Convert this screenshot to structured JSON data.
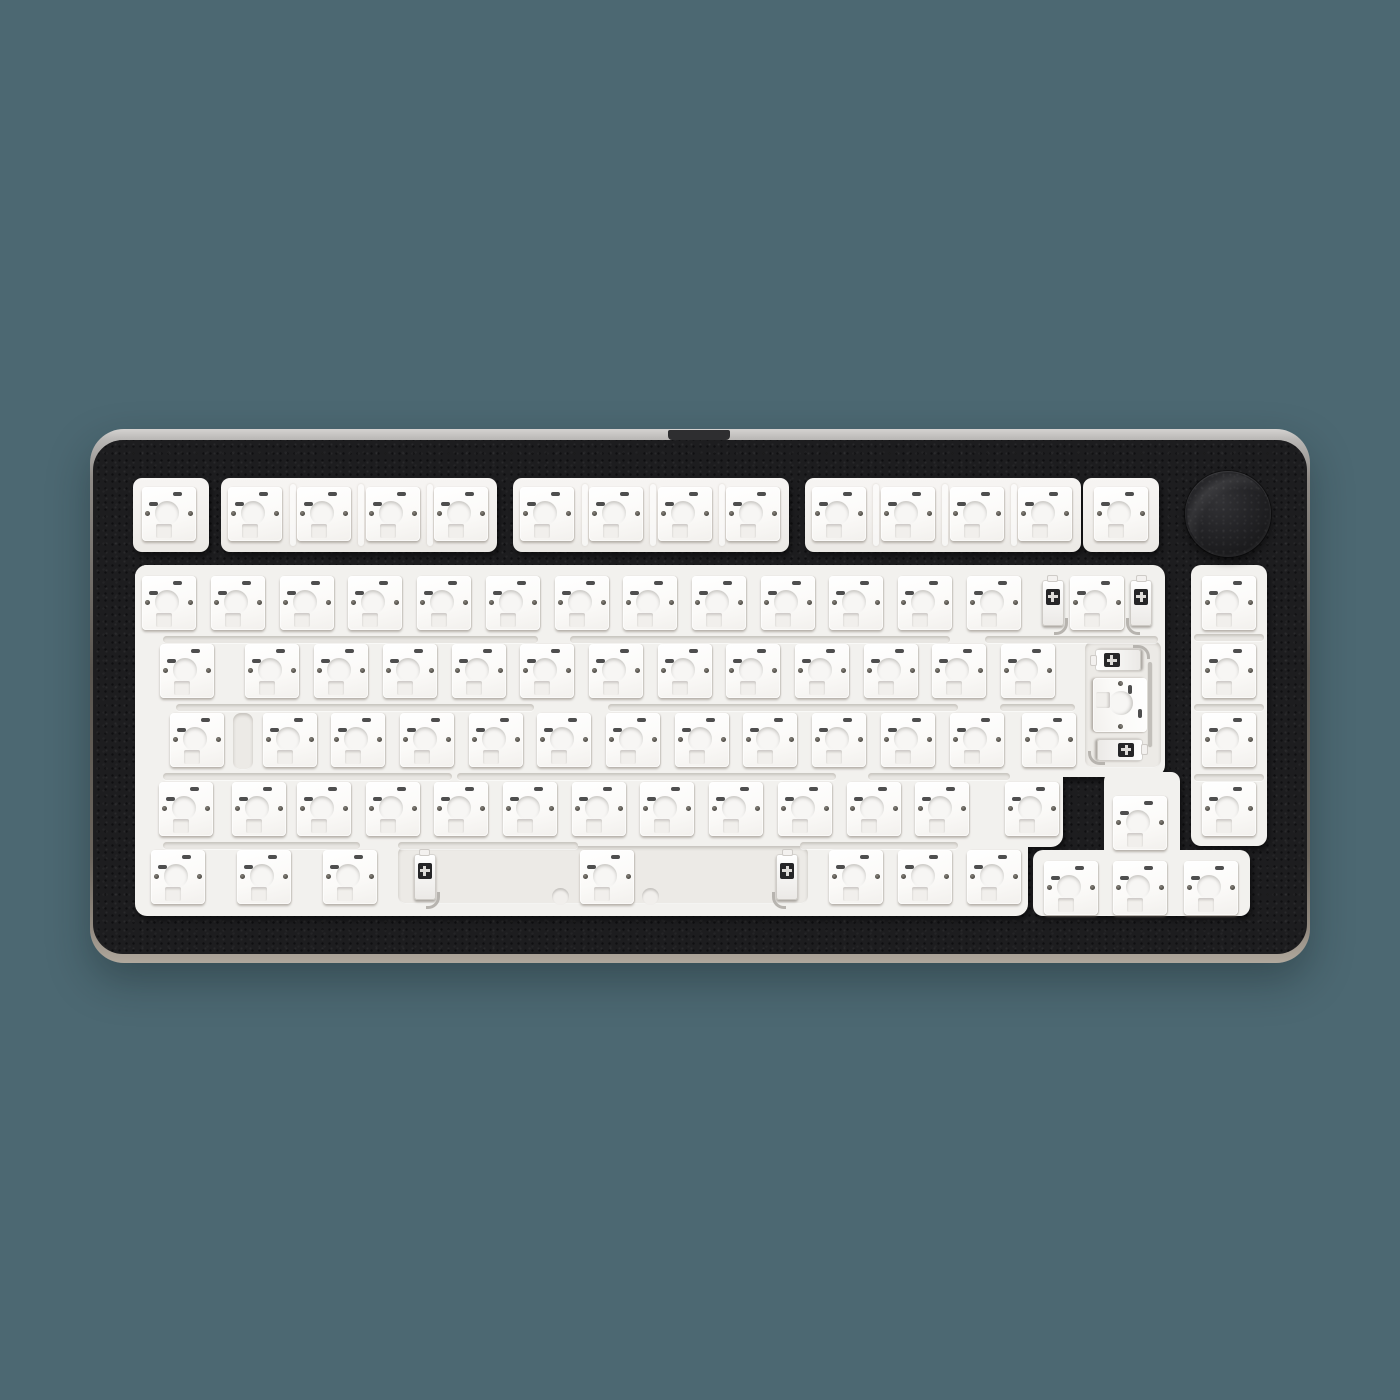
{
  "scene": {
    "type": "product-photo",
    "subject": "75 percent barebones hot-swap mechanical keyboard with black aluminum case, white plate with empty hot-swap sockets, no keycaps, and a black rotary knob in the top right corner",
    "background_color": "#4c6872"
  },
  "keyboard": {
    "form_factor": "75% exploded layout with knob",
    "keycaps_installed": false,
    "socket_count": 83,
    "colors": {
      "case": "#1d1d1f",
      "case_speckle": "#3c3c3e",
      "rim_top": "#cac8c6",
      "rim_bottom": "#aba396",
      "plate": "#f2f1ee",
      "socket": "#fbfaf8",
      "recess": "#eceae6",
      "knob": "#1b1b1d",
      "stab_slot": "#262628",
      "contact_dot": "#4a4842",
      "pin_dash": "#2f2f2f",
      "background": "#4c6872"
    },
    "knob": {
      "present": true,
      "position": "top-right",
      "shape": "round"
    },
    "rows": [
      {
        "id": "function-row",
        "keys": [
          {
            "id": "esc",
            "cu": 0.5
          },
          {
            "id": "f1",
            "cu": 1.75
          },
          {
            "id": "f2",
            "cu": 2.75
          },
          {
            "id": "f3",
            "cu": 3.75
          },
          {
            "id": "f4",
            "cu": 4.75
          },
          {
            "id": "f5",
            "cu": 6.0
          },
          {
            "id": "f6",
            "cu": 7.0
          },
          {
            "id": "f7",
            "cu": 8.0
          },
          {
            "id": "f8",
            "cu": 9.0
          },
          {
            "id": "f9",
            "cu": 10.25
          },
          {
            "id": "f10",
            "cu": 11.25
          },
          {
            "id": "f11",
            "cu": 12.25
          },
          {
            "id": "f12",
            "cu": 13.25
          },
          {
            "id": "del",
            "cu": 14.35
          }
        ]
      },
      {
        "id": "number-row",
        "keys": [
          {
            "id": "grave",
            "cu": 0.5
          },
          {
            "id": "num1",
            "cu": 1.5
          },
          {
            "id": "num2",
            "cu": 2.5
          },
          {
            "id": "num3",
            "cu": 3.5
          },
          {
            "id": "num4",
            "cu": 4.5
          },
          {
            "id": "num5",
            "cu": 5.5
          },
          {
            "id": "num6",
            "cu": 6.5
          },
          {
            "id": "num7",
            "cu": 7.5
          },
          {
            "id": "num8",
            "cu": 8.5
          },
          {
            "id": "num9",
            "cu": 9.5
          },
          {
            "id": "num0",
            "cu": 10.5
          },
          {
            "id": "minus",
            "cu": 11.5
          },
          {
            "id": "equals",
            "cu": 12.5
          },
          {
            "id": "backspace",
            "cu": 14.0
          }
        ]
      },
      {
        "id": "upper-row",
        "keys": [
          {
            "id": "tab",
            "cu": 0.75
          },
          {
            "id": "q",
            "cu": 2.0
          },
          {
            "id": "w",
            "cu": 3.0
          },
          {
            "id": "e",
            "cu": 4.0
          },
          {
            "id": "r",
            "cu": 5.0
          },
          {
            "id": "t",
            "cu": 6.0
          },
          {
            "id": "y",
            "cu": 7.0
          },
          {
            "id": "u",
            "cu": 8.0
          },
          {
            "id": "i",
            "cu": 9.0
          },
          {
            "id": "o",
            "cu": 10.0
          },
          {
            "id": "p",
            "cu": 11.0
          },
          {
            "id": "lbracket",
            "cu": 12.0
          },
          {
            "id": "rbracket",
            "cu": 13.0
          }
        ]
      },
      {
        "id": "home-row",
        "keys": [
          {
            "id": "caps",
            "cu": 0.9
          },
          {
            "id": "a",
            "cu": 2.25
          },
          {
            "id": "s",
            "cu": 3.25
          },
          {
            "id": "d",
            "cu": 4.25
          },
          {
            "id": "f",
            "cu": 5.25
          },
          {
            "id": "g",
            "cu": 6.25
          },
          {
            "id": "h",
            "cu": 7.25
          },
          {
            "id": "j",
            "cu": 8.25
          },
          {
            "id": "k",
            "cu": 9.25
          },
          {
            "id": "l",
            "cu": 10.25
          },
          {
            "id": "semicolon",
            "cu": 11.25
          },
          {
            "id": "quote",
            "cu": 12.25
          },
          {
            "id": "enter",
            "cu": 13.3
          }
        ]
      },
      {
        "id": "lower-row",
        "keys": [
          {
            "id": "lshift",
            "cu": 0.74
          },
          {
            "id": "iso-backslash",
            "cu": 1.8
          },
          {
            "id": "z",
            "cu": 2.75
          },
          {
            "id": "x",
            "cu": 3.75
          },
          {
            "id": "c",
            "cu": 4.75
          },
          {
            "id": "v",
            "cu": 5.75
          },
          {
            "id": "b",
            "cu": 6.75
          },
          {
            "id": "n",
            "cu": 7.75
          },
          {
            "id": "m",
            "cu": 8.75
          },
          {
            "id": "comma",
            "cu": 9.75
          },
          {
            "id": "period",
            "cu": 10.75
          },
          {
            "id": "slash",
            "cu": 11.75
          },
          {
            "id": "rshift",
            "cu": 13.06
          }
        ]
      },
      {
        "id": "bottom-row",
        "keys": [
          {
            "id": "lctrl",
            "cu": 0.625
          },
          {
            "id": "lwin",
            "cu": 1.875
          },
          {
            "id": "lalt",
            "cu": 3.125
          },
          {
            "id": "space",
            "cu": 6.875
          },
          {
            "id": "ralt",
            "cu": 10.5
          },
          {
            "id": "fn",
            "cu": 11.5
          },
          {
            "id": "rctrl",
            "cu": 12.5
          }
        ]
      }
    ],
    "right_column_keys": [
      {
        "id": "home"
      },
      {
        "id": "pageup"
      },
      {
        "id": "pagedown"
      },
      {
        "id": "end"
      }
    ],
    "arrow_keys": [
      {
        "id": "up"
      },
      {
        "id": "left"
      },
      {
        "id": "down"
      },
      {
        "id": "right"
      }
    ],
    "extra_sockets": [
      {
        "id": "iso-enter",
        "rotated": true
      }
    ],
    "stabilizers": [
      {
        "id": "backspace-stabilizer",
        "orientation": "horizontal"
      },
      {
        "id": "iso-enter-stabilizer",
        "orientation": "vertical"
      },
      {
        "id": "spacebar-stabilizer",
        "orientation": "horizontal"
      }
    ]
  }
}
